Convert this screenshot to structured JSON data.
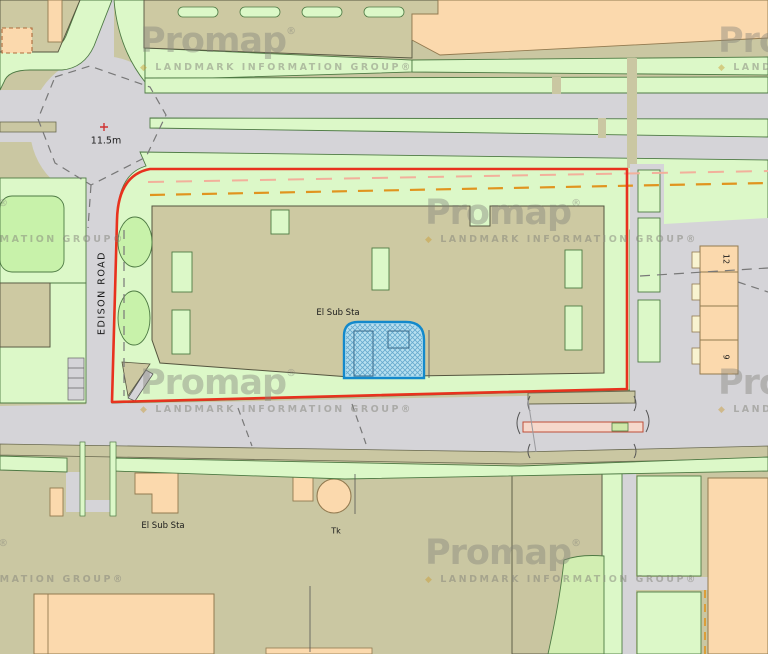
{
  "map": {
    "watermark": {
      "brand": "Promap",
      "registered": "®",
      "bullet": "◆",
      "subtitle": "LANDMARK INFORMATION GROUP",
      "positions": [
        [
          140,
          24
        ],
        [
          718,
          24
        ],
        [
          -148,
          196
        ],
        [
          425,
          196
        ],
        [
          140,
          366
        ],
        [
          718,
          366
        ],
        [
          -148,
          536
        ],
        [
          425,
          536
        ]
      ]
    },
    "labels": [
      {
        "id": "spot-height",
        "text": "11.5m",
        "x": 106,
        "y": 141,
        "rotation": 0,
        "size": 9.5
      },
      {
        "id": "edison-road",
        "text": "EDISON ROAD",
        "x": 102,
        "y": 293,
        "rotation": -90,
        "size": 9.5,
        "letterSpacing": 1.5
      },
      {
        "id": "el-sub-sta-site",
        "text": "El Sub Sta",
        "x": 338,
        "y": 313,
        "rotation": 0,
        "size": 8.5
      },
      {
        "id": "el-sub-sta-south",
        "text": "El Sub Sta",
        "x": 163,
        "y": 526,
        "rotation": 0,
        "size": 8.5
      },
      {
        "id": "tank",
        "text": "Tk",
        "x": 336,
        "y": 531,
        "rotation": 0,
        "size": 8
      },
      {
        "id": "house-number-12",
        "text": "12",
        "x": 726,
        "y": 259,
        "rotation": 90,
        "size": 8
      },
      {
        "id": "house-number-9",
        "text": "9",
        "x": 726,
        "y": 357,
        "rotation": 90,
        "size": 8
      }
    ],
    "colors": {
      "roadGray": "#d5d4d8",
      "baseKhaki": "#cac7a2",
      "bldKhaki": "#cdc9a2",
      "outline": "#55553f",
      "paleGreen": "#dcf8c8",
      "greenLine": "#4e7a44",
      "brightGreen": "#c8f2aa",
      "peach": "#fbd9ad",
      "peachLine": "#927a50",
      "cream": "#f8f3d0",
      "blueFill": "#b7e0f0",
      "blueLine": "#1389cb",
      "hatch": "#66a9cd",
      "red": "#e8321e",
      "orangeDash": "#e0941f",
      "salmonDash": "#f2b09b",
      "pinkBar": "#f6d8cb",
      "pinkLine": "#bf4e38",
      "dashGray": "#787878",
      "label": "#1a1a1a",
      "wm": "#83837a",
      "wmDot": "#c9992f"
    }
  }
}
